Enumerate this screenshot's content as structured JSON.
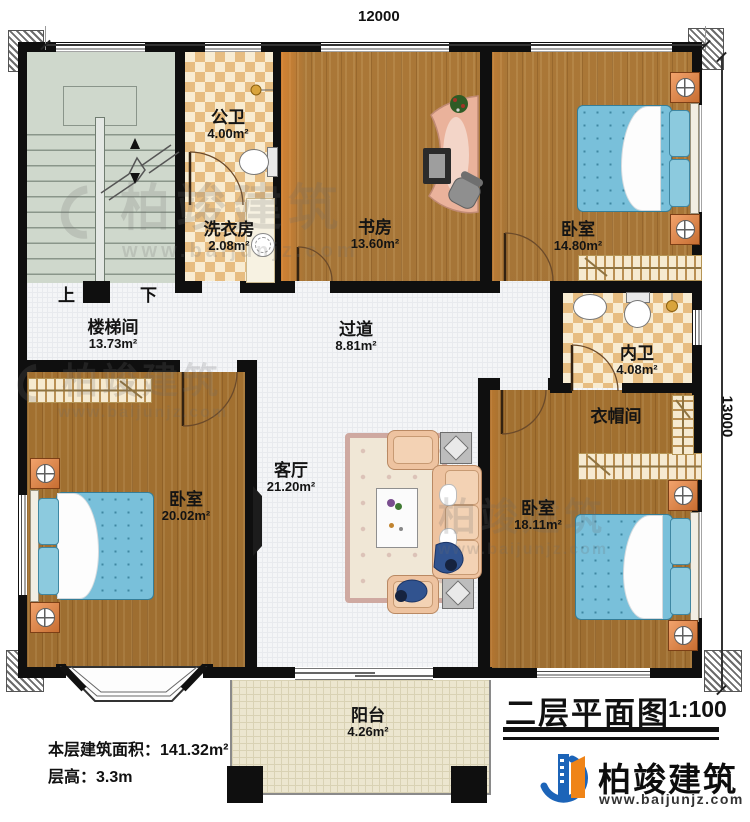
{
  "title": {
    "text": "二层平面图",
    "scale": "1:100"
  },
  "dimensions": {
    "top": "12000",
    "right": "13000"
  },
  "meta": {
    "floor_area_label": "本层建筑面积：",
    "floor_area_value": "141.32m²",
    "floor_height_label": "层高：",
    "floor_height_value": "3.3m"
  },
  "stairs": {
    "up": "上",
    "down": "下"
  },
  "rooms": [
    {
      "id": "public-bath",
      "name": "公卫",
      "area": "4.00m²"
    },
    {
      "id": "laundry",
      "name": "洗衣房",
      "area": "2.08m²"
    },
    {
      "id": "study",
      "name": "书房",
      "area": "13.60m²"
    },
    {
      "id": "bedroom-ne",
      "name": "卧室",
      "area": "14.80m²"
    },
    {
      "id": "stair-hall",
      "name": "楼梯间",
      "area": "13.73m²"
    },
    {
      "id": "hallway",
      "name": "过道",
      "area": "8.81m²"
    },
    {
      "id": "inner-bath",
      "name": "内卫",
      "area": "4.08m²"
    },
    {
      "id": "cloakroom",
      "name": "衣帽间",
      "area": ""
    },
    {
      "id": "bedroom-sw",
      "name": "卧室",
      "area": "20.02m²"
    },
    {
      "id": "living",
      "name": "客厅",
      "area": "21.20m²"
    },
    {
      "id": "bedroom-se",
      "name": "卧室",
      "area": "18.11m²"
    },
    {
      "id": "balcony",
      "name": "阳台",
      "area": "4.26m²"
    }
  ],
  "brand": {
    "name": "柏竣建筑",
    "website": "www.baijunjz.com"
  },
  "watermark": {
    "name": "柏竣建筑",
    "site": "www.baijunjz.com"
  },
  "colors": {
    "wall": "#0f0f0f",
    "wood_floor": "#b5823f",
    "bath_tile": "#e7bd81",
    "stair_floor": "#cfd8cc",
    "hall_floor": "#f4f5f7",
    "balcony_floor": "#ece6cf",
    "bed_blue": "#79c0da",
    "nightstand_orange": "#d9854a",
    "logo_blue": "#1c64b8",
    "logo_orange": "#ef8418"
  }
}
